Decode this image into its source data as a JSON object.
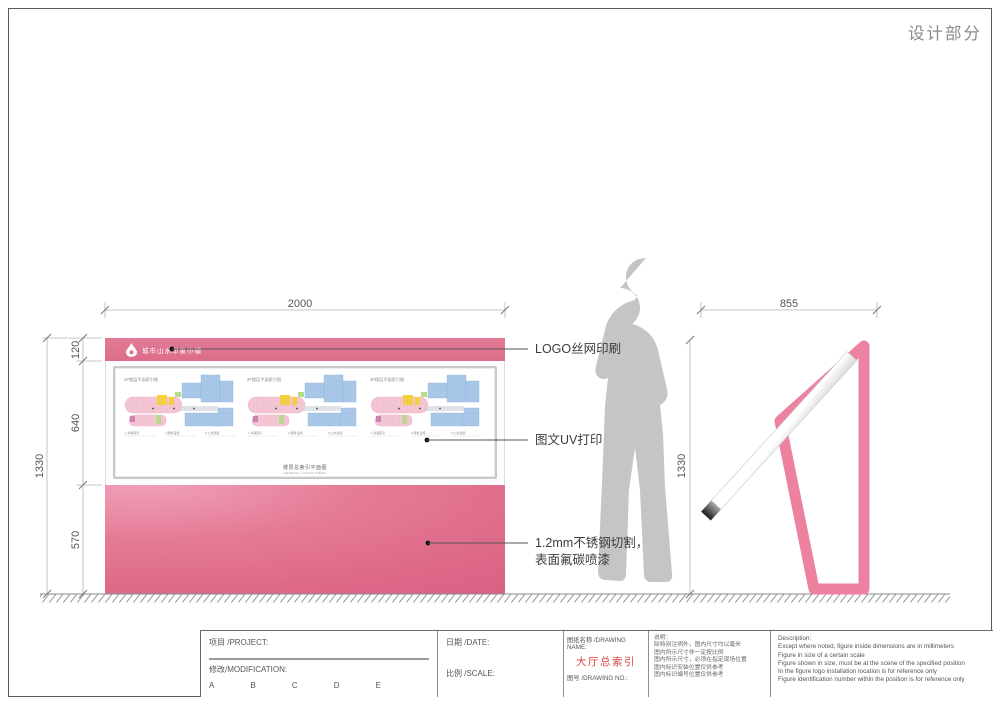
{
  "page": {
    "title": "设计部分"
  },
  "front_view": {
    "logo_text": "城市山水印象小镇",
    "plans": [
      {
        "title": "1F楼层平面索引图"
      },
      {
        "title": "2F楼层平面索引图"
      },
      {
        "title": "3F楼层平面索引图"
      }
    ],
    "legend": [
      "1 商铺索引",
      "2 服务设施",
      "3 公共通道"
    ],
    "caption_line1": "楼层总索引平面图",
    "caption_line2": "GENERAL FLOOR INDEX"
  },
  "dimensions": {
    "front_width": "2000",
    "front_total_height": "1330",
    "header_height": "120",
    "board_height": "640",
    "base_height": "570",
    "side_width": "855",
    "side_height": "1330"
  },
  "annotations": {
    "logo": "LOGO丝网印刷",
    "uv": "图文UV打印",
    "steel1": "1.2mm不锈钢切割，",
    "steel2": "表面氟碳喷漆"
  },
  "title_block": {
    "project_label": "项目 /PROJECT:",
    "modification_label": "修改/MODIFICATION:",
    "revisions": [
      "A",
      "B",
      "C",
      "D",
      "E"
    ],
    "date_label": "日期 /DATE:",
    "scale_label": "比例 /SCALE:",
    "drawing_name_label": "图纸名称 /DRAWING NAME:",
    "drawing_name": "大厅总索引",
    "drawing_no_label": "图号 /DRAWING NO.:",
    "notes_title": "说明：",
    "notes_lines": [
      "除特别注明外，图内尺寸均以毫米",
      "图内所示尺寸非一定按比例",
      "图内所示尺寸，必须在指定现场位置",
      "图内标识安装位置仅供参考",
      "图内标识编号位置仅供参考"
    ],
    "description_title": "Description:",
    "description_lines": [
      "Except where noted, figure inside dimensions are in millimeters",
      "Figure in size of a certain scale",
      "Figure shown in size, must be at the scene of the specified position",
      "In the figure logo installation location is for reference only",
      "Figure identification number within the position is for reference only"
    ]
  },
  "colors": {
    "pink": "#e2738f",
    "pink_frame": "#ec82a0",
    "drawing_name_red": "#d84040",
    "silhouette_gray": "#c5c5c5"
  }
}
